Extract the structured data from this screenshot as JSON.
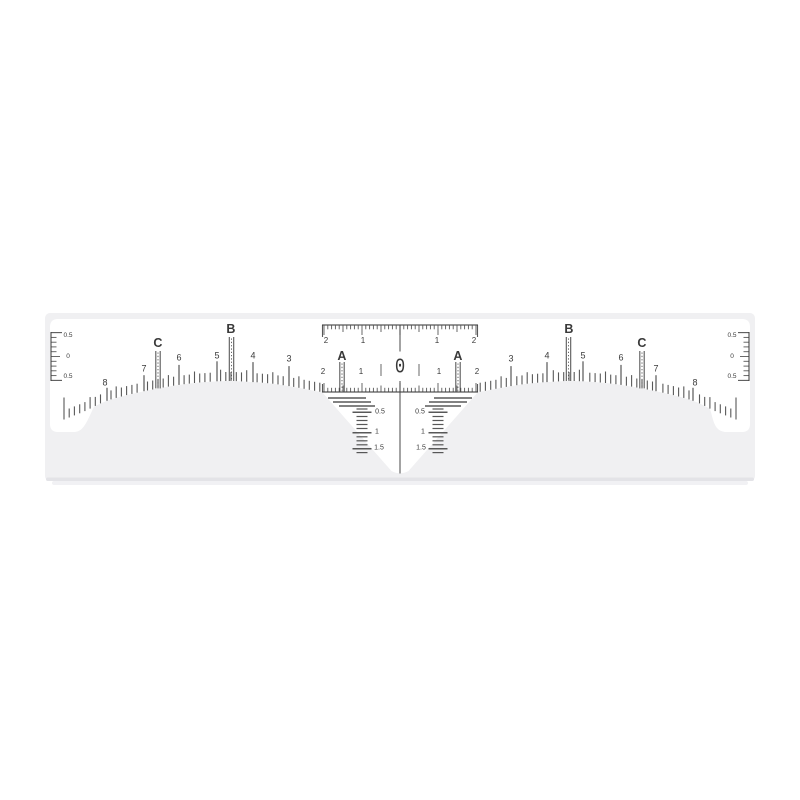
{
  "product_photo": {
    "colors": {
      "page_background": "#ffffff",
      "backing": "#f0f0f2",
      "backing_edge": "#e3e3e7",
      "sticker": "#ffffff",
      "ink": "#414141"
    }
  },
  "ruler": {
    "center_label": "0",
    "marker_letters": {
      "a": "A",
      "b": "B",
      "c": "C"
    },
    "arch_numbers": [
      "3",
      "4",
      "5",
      "6",
      "7",
      "8"
    ],
    "top_scale_labels": [
      "2",
      "1",
      "1",
      "2"
    ],
    "mid_scale_labels": [
      "2",
      "1",
      "1",
      "2"
    ],
    "side_scale_labels": [
      "0.5",
      "0",
      "0.5"
    ],
    "vertical_scale_labels": [
      "0.5",
      "1",
      "1.5"
    ]
  }
}
